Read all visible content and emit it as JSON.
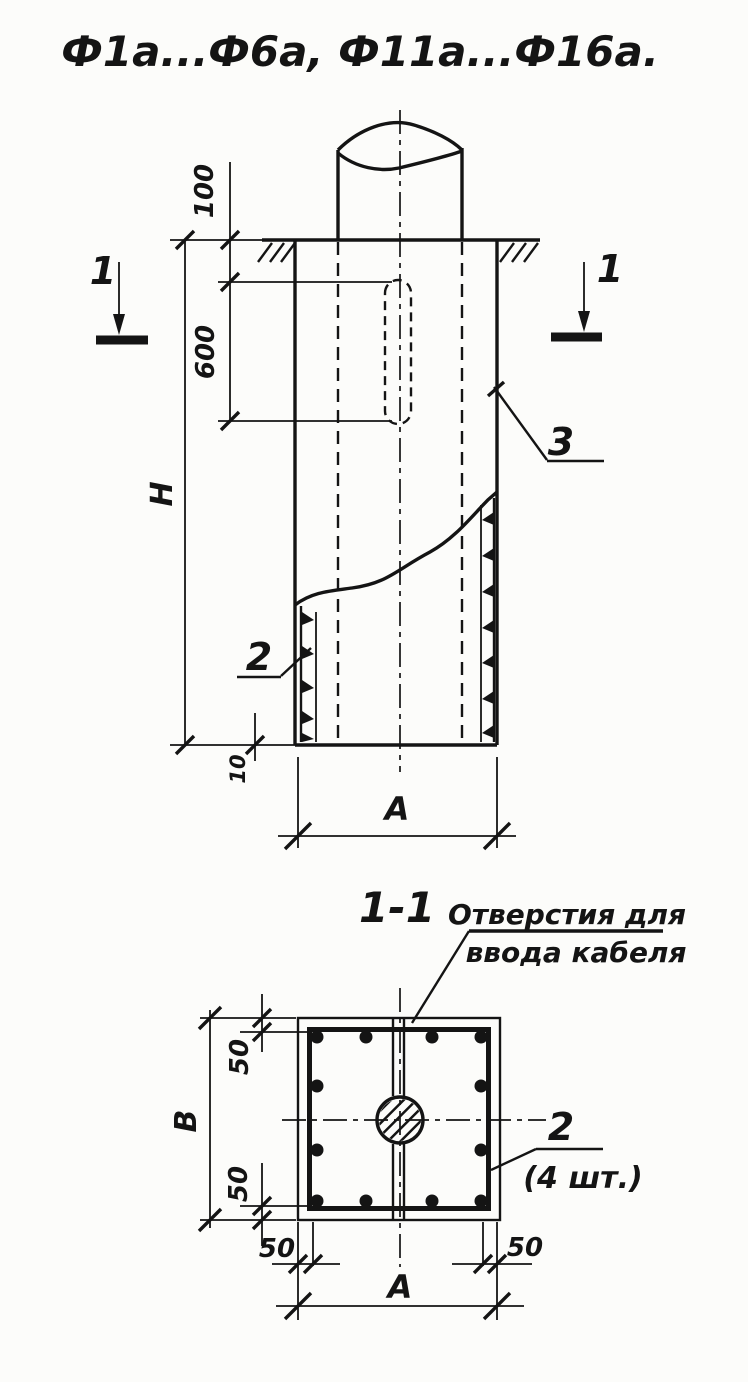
{
  "drawing": {
    "title": "Ф1а...Ф6а,   Ф11а...Ф16а.",
    "colors": {
      "ink": "#141414",
      "paper": "#fcfcfa"
    }
  },
  "elevation": {
    "dim_100": "100",
    "dim_600": "600",
    "dim_H": "Н",
    "dim_10": "10",
    "dim_A": "А",
    "callout_rebar": "2",
    "callout_sleeve": "3",
    "section_mark": "1"
  },
  "section": {
    "title": "1-1",
    "note_line1": "Отверстия для",
    "note_line2": "ввода кабеля",
    "dim_B": "В",
    "dim_50": "50",
    "dim_A": "А",
    "callout_rebar": "2",
    "callout_qty": "(4 шт.)"
  }
}
